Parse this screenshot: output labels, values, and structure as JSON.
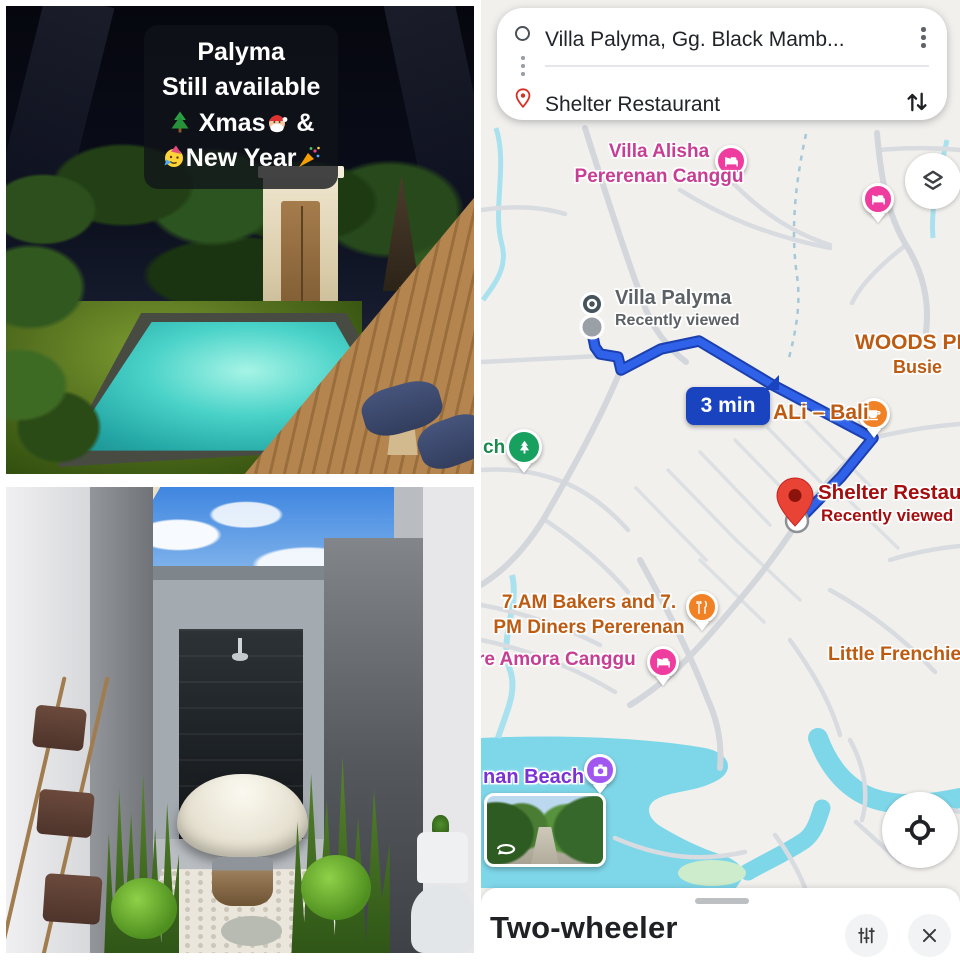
{
  "collage": {
    "pool_overlay": {
      "line1": "Palyma",
      "line2": "Still available",
      "line3_text": "Xmas",
      "line3_amp": " &",
      "line4_text": "New Year"
    }
  },
  "map": {
    "card": {
      "origin": "Villa Palyma, Gg. Black Mamb...",
      "destination": "Shelter Restaurant"
    },
    "route": {
      "duration_badge": "3 min"
    },
    "labels": {
      "villa_alisha_line1": "Villa Alisha",
      "villa_alisha_line2": "Pererenan Canggu",
      "villa_palyma_title": "Villa Palyma",
      "villa_palyma_subtitle": "Recently viewed",
      "woods_line1": "WOODS PE",
      "woods_line2": "Busie",
      "ali_bali": "ALi – Bali",
      "shelter_title": "Shelter Restaur",
      "shelter_subtitle": "Recently viewed",
      "bakers_line1": "7.AM Bakers and 7.",
      "bakers_line2": "PM Diners Pererenan",
      "amora": "re Amora Canggu",
      "little_frenchie": "Little Frenchie",
      "beach": "nan Beach",
      "park_partial": "ch"
    },
    "bottom_sheet": {
      "title": "Two-wheeler"
    },
    "colors": {
      "route_blue": "#2f62e8",
      "route_casing": "#1b3fae",
      "badge_navy": "#1a44bf",
      "poi_pink": "#ef3c9f",
      "poi_pink_text": "#c73e95",
      "poi_orange": "#f08124",
      "poi_orange_text": "#bd5b12",
      "poi_purple": "#a256f0",
      "poi_purple_text": "#7b32d4",
      "poi_green": "#17a05e",
      "poi_green_text": "#1c8a4e",
      "destination_red": "#a50e0e",
      "water": "#7ed7e9",
      "gray_label": "#5c6166"
    }
  }
}
